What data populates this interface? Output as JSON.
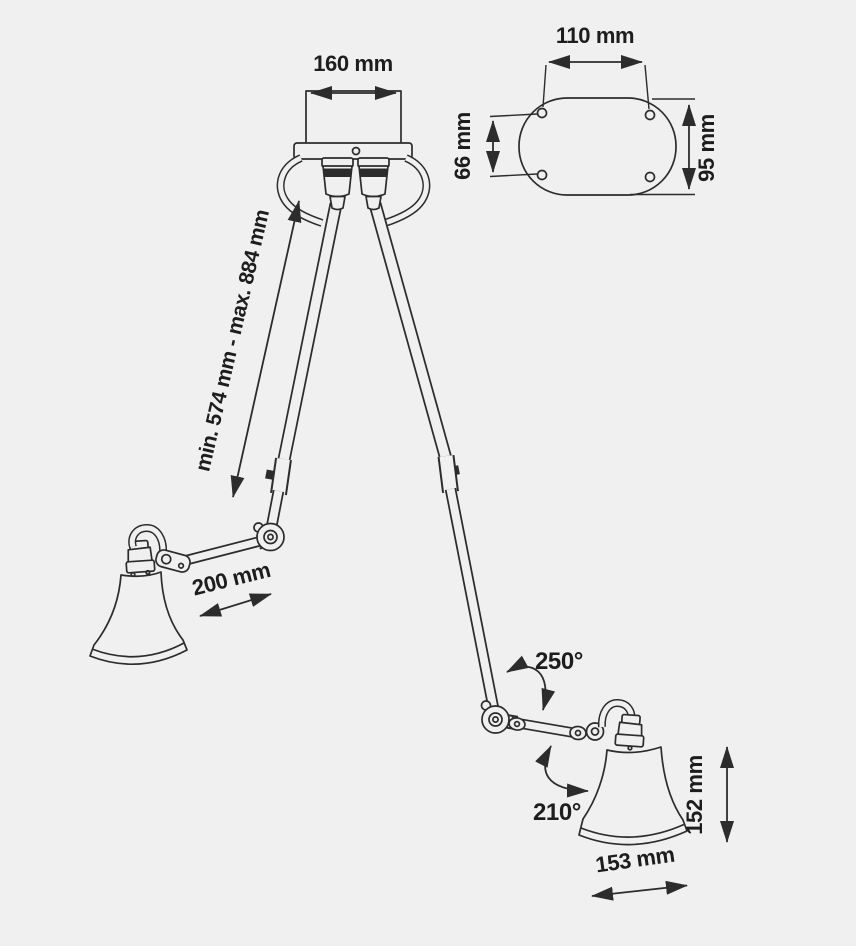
{
  "colors": {
    "background": "#f0f0f0",
    "line": "#2c2c2c",
    "label_text": "#1d1d1d"
  },
  "diagram": {
    "type": "product-dimension-drawing",
    "subject": "double-arm articulated ceiling lamp",
    "labels": {
      "canopy_width": "160 mm",
      "plate_width": "110 mm",
      "plate_hole_spacing": "66 mm",
      "plate_height": "95 mm",
      "arm_length_range": "min. 574 mm - max. 884 mm",
      "forearm_length": "200 mm",
      "elbow_rotation": "250°",
      "shade_rotation": "210°",
      "shade_height": "152 mm",
      "shade_width": "153 mm"
    }
  }
}
